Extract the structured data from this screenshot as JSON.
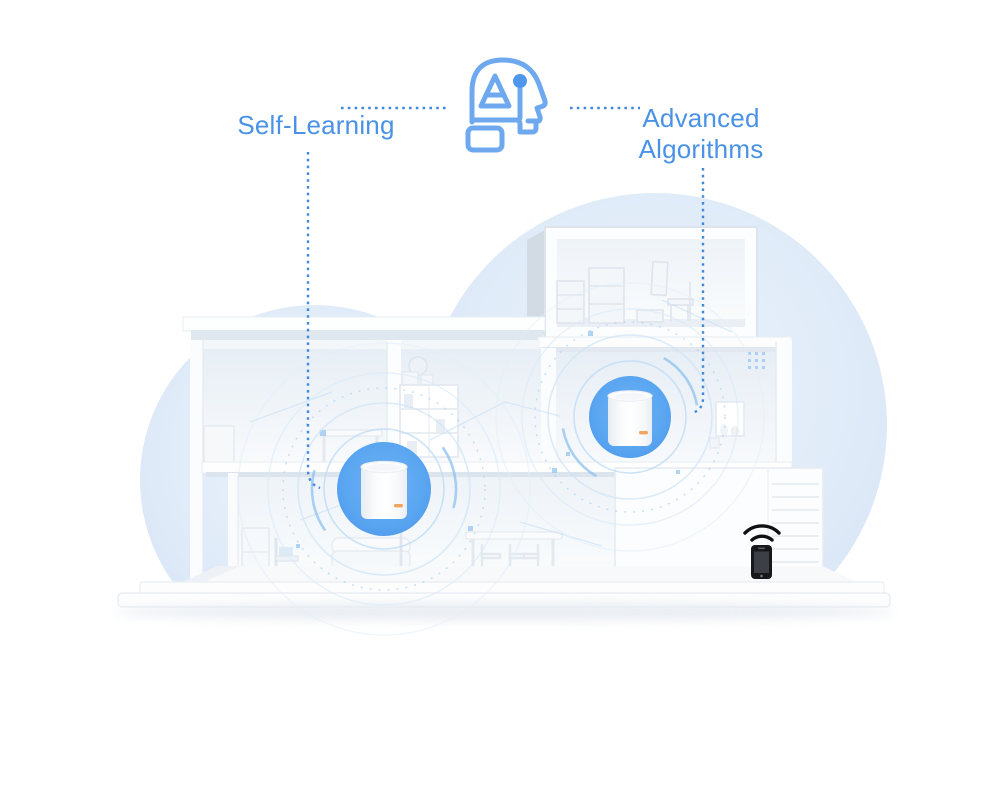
{
  "callouts": {
    "self_learning": "Self-Learning",
    "advanced_algorithms": "Advanced Algorithms"
  },
  "icons": {
    "ai_head": "ai-head-icon",
    "wifi": "wifi-icon",
    "smartphone": "smartphone-icon"
  },
  "scene": {
    "mesh_nodes": [
      {
        "name": "mesh-router-ground-floor",
        "halo": "blue-circle"
      },
      {
        "name": "mesh-router-second-floor",
        "halo": "blue-circle"
      }
    ],
    "client_device": "smartphone-with-wifi"
  },
  "colors": {
    "label_blue": "#4a92e6",
    "dashed_line_blue": "#4289dd",
    "halo_blue": "#5ba6f1",
    "blob_blue": "#dde9f7",
    "icon_stroke_blue": "#6ea8ef",
    "router_body": "#ffffff",
    "phone_black": "#17181b"
  }
}
